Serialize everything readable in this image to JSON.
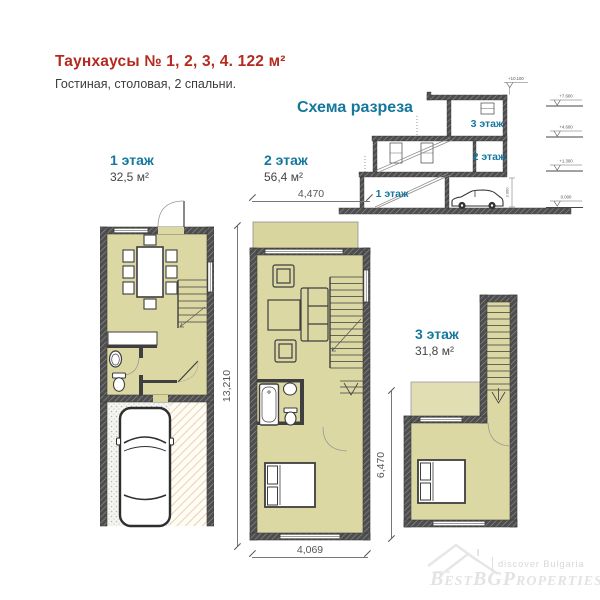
{
  "page": {
    "title": "Таунхаусы № 1, 2, 3, 4. 122 м²",
    "subtitle": "Гостиная, столовая, 2 спальни."
  },
  "section_scheme": {
    "title": "Схема разреза",
    "floors": [
      "1 этаж",
      "2 этаж",
      "3 этаж"
    ],
    "elevation_top": "+10.100",
    "elevations": [
      "+7.600",
      "+4.600",
      "+1.300",
      "0.000"
    ],
    "height_dim": "3.000"
  },
  "floor_plans": {
    "floor1": {
      "label": "1 этаж",
      "area": "32,5 м²"
    },
    "floor2": {
      "label": "2 этаж",
      "area": "56,4 м²"
    },
    "floor3": {
      "label": "3 этаж",
      "area": "31,8 м²"
    }
  },
  "dimensions": {
    "plan2_width_top": "4,470",
    "plan2_height": "13,210",
    "plan2_width_bottom": "4,069",
    "plan3_height": "6,470"
  },
  "watermark": {
    "tagline": "discover Bulgaria",
    "brand": "BestBGProperties"
  },
  "colors": {
    "accent_red": "#b42a20",
    "accent_teal": "#15779e",
    "floor_fill": "#dcd8a4",
    "terrace_fill": "#e1deb4",
    "wall": "#4e4e4e"
  }
}
